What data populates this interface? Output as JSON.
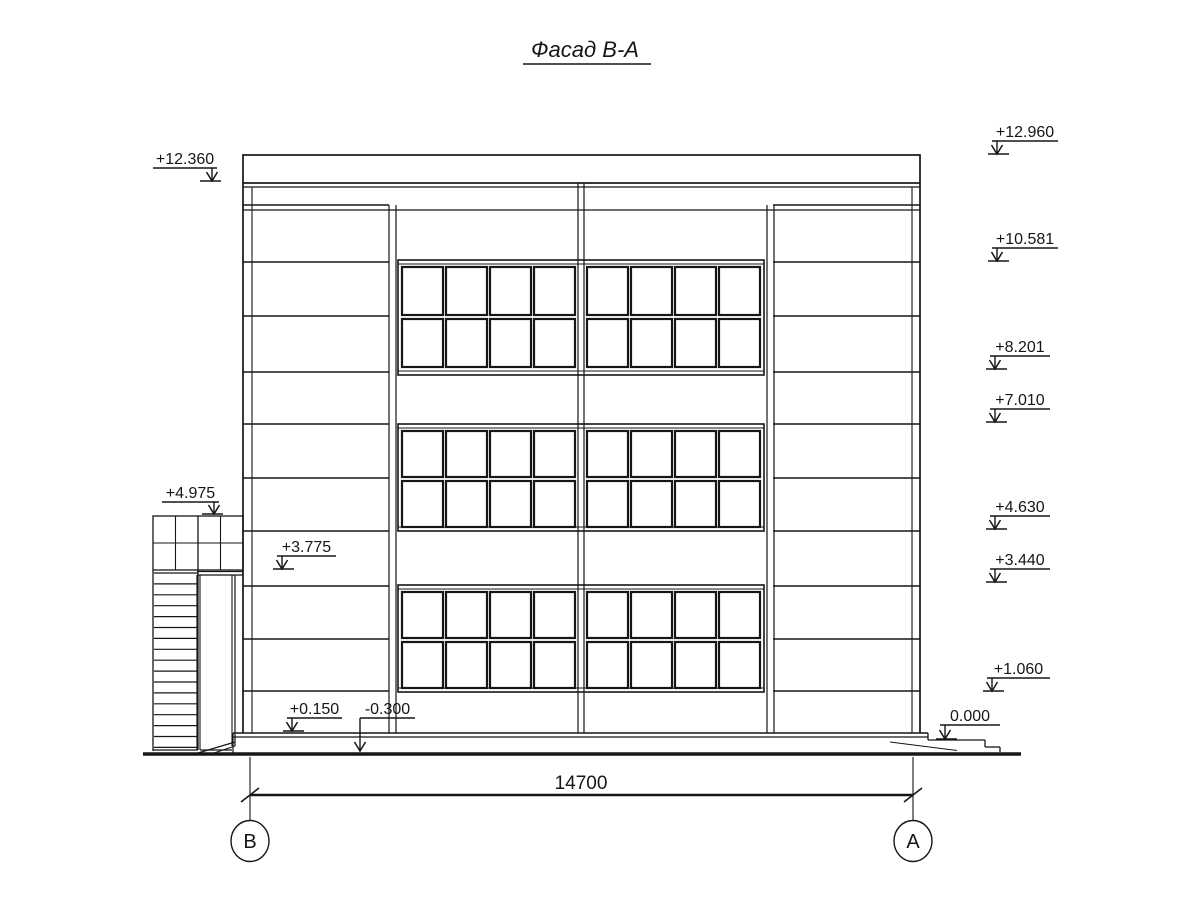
{
  "title": {
    "text": "Фасад В-А"
  },
  "drawing": {
    "background": "#ffffff",
    "line_color": "#161616"
  },
  "dimension": {
    "value": "14700"
  },
  "axes": [
    {
      "label": "В"
    },
    {
      "label": "А"
    }
  ],
  "elevation_marks": [
    {
      "label": "+12.960",
      "x": 992,
      "w": 66,
      "y": 141,
      "arrow": "start",
      "tipY": 154
    },
    {
      "label": "+10.581",
      "x": 992,
      "w": 66,
      "y": 248,
      "arrow": "start",
      "tipY": 261
    },
    {
      "label": "+8.201",
      "x": 990,
      "w": 60,
      "y": 356,
      "arrow": "start",
      "tipY": 369
    },
    {
      "label": "+7.010",
      "x": 990,
      "w": 60,
      "y": 409,
      "arrow": "start",
      "tipY": 422
    },
    {
      "label": "+4.630",
      "x": 990,
      "w": 60,
      "y": 516,
      "arrow": "start",
      "tipY": 529
    },
    {
      "label": "+3.440",
      "x": 990,
      "w": 60,
      "y": 569,
      "arrow": "start",
      "tipY": 582
    },
    {
      "label": "+1.060",
      "x": 987,
      "w": 63,
      "y": 678,
      "arrow": "start",
      "tipY": 691
    },
    {
      "label": "0.000",
      "x": 940,
      "w": 60,
      "y": 725,
      "arrow": "start",
      "tipY": 739
    },
    {
      "label": "+12.360",
      "x": 153,
      "w": 64,
      "y": 168,
      "arrow": "end",
      "tipY": 181
    },
    {
      "label": "+4.975",
      "x": 162,
      "w": 57,
      "y": 502,
      "arrow": "end",
      "tipY": 514
    },
    {
      "label": "+3.775",
      "x": 277,
      "w": 59,
      "y": 556,
      "arrow": "start",
      "tipY": 569
    },
    {
      "label": "+0.150",
      "x": 287,
      "w": 55,
      "y": 718,
      "arrow": "start",
      "tipY": 731
    },
    {
      "label": "-0.300",
      "x": 360,
      "w": 55,
      "y": 718,
      "arrow": "leader",
      "tipY": 751
    }
  ],
  "facade": {
    "floors": 3,
    "window_rows_per_floor": 2,
    "windows_per_row": 8,
    "band_x": [
      398,
      764
    ],
    "window_bands": [
      {
        "top": 260,
        "bottom": 375,
        "inner_top": 264,
        "inner_bottom": 371,
        "rows": [
          [
            267,
            315
          ],
          [
            319,
            367
          ]
        ]
      },
      {
        "top": 424,
        "bottom": 531,
        "inner_top": 428,
        "inner_bottom": 527,
        "rows": [
          [
            431,
            477
          ],
          [
            481,
            527
          ]
        ]
      },
      {
        "top": 585,
        "bottom": 692,
        "inner_top": 589,
        "inner_bottom": 688,
        "rows": [
          [
            592,
            638
          ],
          [
            642,
            688
          ]
        ]
      }
    ],
    "window_columns": [
      [
        402,
        443
      ],
      [
        446,
        487
      ],
      [
        490,
        531
      ],
      [
        534,
        575
      ],
      [
        587,
        628
      ],
      [
        631,
        672
      ],
      [
        675,
        716
      ],
      [
        719,
        760
      ]
    ],
    "side_panel_line_ys": [
      205,
      262,
      316,
      372,
      424,
      478,
      531,
      586,
      639,
      691
    ],
    "side_segments": [
      [
        243,
        389
      ],
      [
        773,
        920
      ]
    ],
    "stair_treads": {
      "x1": 154,
      "x2": 198,
      "y_top": 573,
      "count": 17,
      "step": 10.9
    }
  }
}
